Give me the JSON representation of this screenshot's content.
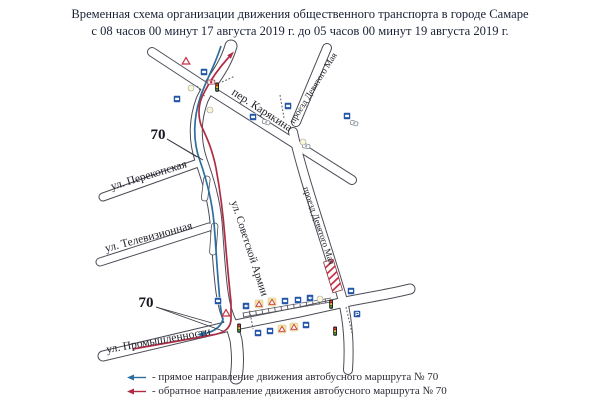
{
  "title": {
    "line1": "Временная схема организации движения общественного транспорта в городе Самаре",
    "line2": "с 08 часов 00 минут 17 августа 2019 г. до 05 часов 00 минут 19 августа 2019 г."
  },
  "map": {
    "route_number_label_1": "70",
    "route_number_label_2": "70",
    "street_labels": [
      {
        "id": "karyakina",
        "text": "пер. Карякина"
      },
      {
        "id": "devyatogo-maya-upper",
        "text": "проезд Девятого Мая"
      },
      {
        "id": "devyatogo-maya-lower",
        "text": "проезд Девятого Мая"
      },
      {
        "id": "sovetskoy-armii",
        "text": "ул. Советской Армии"
      },
      {
        "id": "perekopskaya",
        "text": "ул. Перекопская"
      },
      {
        "id": "televizionnaya",
        "text": "ул. Телевизионная"
      },
      {
        "id": "promyshlennosti",
        "text": "ул. Промышленности"
      }
    ],
    "icons": {
      "bus_stop_sign": "blue square sign with bus pictogram",
      "direction_sign": "blue square sign with white arrow",
      "parking_sign": "blue square parking sign",
      "temporary_warning_sign": "yellow square with red warning triangle",
      "warning_triangle": "red-bordered warning triangle",
      "traffic_light": "three-section traffic light",
      "car": "small car pictogram",
      "road_closure": "red-white hatched closed road section"
    }
  },
  "legend": {
    "items": [
      {
        "arrow_color": "#2d6e9e",
        "label": "- прямое направление движения автобусного маршрута № 70"
      },
      {
        "arrow_color": "#b02c44",
        "label": "- обратное направление движения автобусного маршрута № 70"
      }
    ]
  },
  "colors": {
    "route_forward": "#2d6e9e",
    "route_reverse": "#b02c44",
    "street_casing": "#4c4c58",
    "street_fill": "#ffffff",
    "closure_stripe": "#c63244",
    "title_text": "#1b2136"
  }
}
